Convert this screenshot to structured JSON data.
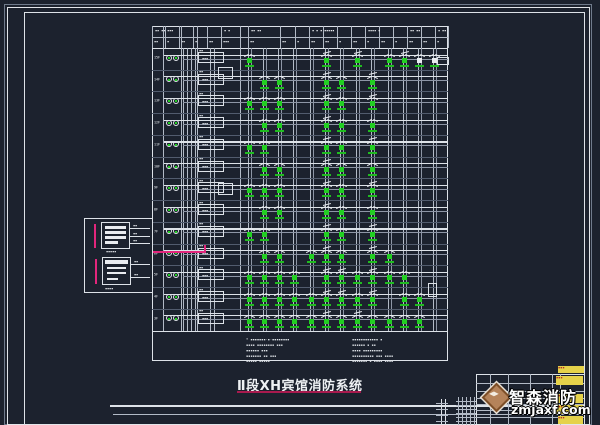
{
  "title": {
    "text": "Ⅱ段XH宾馆消防系统"
  },
  "logo": {
    "name": "智森消防",
    "domain": "zmjaxf.com",
    "diamond_icon": "logo-diamond",
    "accent": "#b5835a"
  },
  "colors": {
    "background": "#1c222e",
    "line": "#b2bac6",
    "bright_line": "#dde2e8",
    "device_green": "#22cf22",
    "magenta": "#e2267c",
    "stamp_yellow": "#e5d24a",
    "title_underline": "#a81a4e"
  },
  "diagram": {
    "box": {
      "left": 152,
      "top": 26,
      "right": 447.5,
      "header_bottom": 48,
      "grid_bottom": 330.5,
      "bottom": 361
    },
    "columns": [
      248,
      263,
      278,
      293,
      310,
      325,
      340,
      356,
      371,
      388,
      403,
      418,
      433
    ],
    "separators": [
      163,
      181,
      197,
      240
    ],
    "risers": [
      183,
      187,
      191,
      195
    ],
    "trunk": [
      209.5,
      213.5
    ],
    "header_cells": [
      0,
      13,
      27,
      41,
      55,
      69,
      96,
      128,
      143,
      157,
      171,
      185,
      199,
      213,
      227,
      241,
      255,
      269,
      283,
      295.5
    ],
    "header_top_tokens": [
      "▪▪ ▪▪ ▪▪▪",
      "▪ ▪",
      "▪▪ ▪▪",
      "▪ ▪ ▪ ▪▪▪▪▪",
      "▪▪▪▪ ▪",
      "▪▪ ▪▪",
      "▪ ▪▪"
    ],
    "header_bot_tokens": [
      "▪▪",
      "▪",
      "▪▪",
      "▪",
      "▪▪",
      "▪▪▪",
      "▪▪",
      "▪▪",
      "▪",
      "▪▪",
      "▪▪",
      "▪",
      "▪▪",
      "▪",
      "▪▪",
      "▪",
      "▪▪",
      "▪▪",
      "▪"
    ],
    "rows": [
      {
        "floor": "15F",
        "devices": [
          [
            1,
            "d"
          ],
          [
            6,
            "w"
          ],
          [
            8,
            "w"
          ],
          [
            10,
            "d"
          ],
          [
            11,
            "w"
          ],
          [
            12,
            "s"
          ],
          [
            13,
            "s"
          ]
        ]
      },
      {
        "floor": "14F",
        "devices": [
          [
            2,
            "d"
          ],
          [
            3,
            "d"
          ],
          [
            6,
            "w"
          ],
          [
            7,
            "d"
          ],
          [
            9,
            "w"
          ]
        ]
      },
      {
        "floor": "13F",
        "devices": [
          [
            1,
            "d"
          ],
          [
            2,
            "d"
          ],
          [
            3,
            "d"
          ],
          [
            6,
            "w"
          ],
          [
            7,
            "d"
          ],
          [
            9,
            "w"
          ]
        ]
      },
      {
        "floor": "12F",
        "devices": [
          [
            2,
            "d"
          ],
          [
            3,
            "d"
          ],
          [
            6,
            "w"
          ],
          [
            7,
            "d"
          ],
          [
            9,
            "d"
          ]
        ]
      },
      {
        "floor": "11F",
        "devices": [
          [
            1,
            "d"
          ],
          [
            2,
            "d"
          ],
          [
            6,
            "w"
          ],
          [
            7,
            "d"
          ],
          [
            9,
            "w"
          ]
        ]
      },
      {
        "floor": "10F",
        "devices": [
          [
            2,
            "d"
          ],
          [
            3,
            "d"
          ],
          [
            6,
            "w"
          ],
          [
            7,
            "d"
          ],
          [
            9,
            "d"
          ]
        ]
      },
      {
        "floor": "9F",
        "devices": [
          [
            1,
            "d"
          ],
          [
            2,
            "d"
          ],
          [
            3,
            "d"
          ],
          [
            6,
            "w"
          ],
          [
            7,
            "d"
          ],
          [
            9,
            "w"
          ]
        ]
      },
      {
        "floor": "8F",
        "devices": [
          [
            2,
            "d"
          ],
          [
            3,
            "d"
          ],
          [
            6,
            "w"
          ],
          [
            7,
            "d"
          ],
          [
            9,
            "d"
          ]
        ]
      },
      {
        "floor": "7F",
        "devices": [
          [
            1,
            "d"
          ],
          [
            2,
            "d"
          ],
          [
            6,
            "w"
          ],
          [
            7,
            "d"
          ],
          [
            9,
            "w"
          ]
        ]
      },
      {
        "floor": "6F",
        "devices": [
          [
            2,
            "d"
          ],
          [
            3,
            "d"
          ],
          [
            5,
            "d"
          ],
          [
            6,
            "w"
          ],
          [
            7,
            "d"
          ],
          [
            9,
            "w"
          ],
          [
            10,
            "d"
          ]
        ]
      },
      {
        "floor": "5F",
        "devices": [
          [
            1,
            "d"
          ],
          [
            2,
            "d"
          ],
          [
            3,
            "d"
          ],
          [
            4,
            "d"
          ],
          [
            6,
            "w"
          ],
          [
            7,
            "w"
          ],
          [
            8,
            "d"
          ],
          [
            9,
            "w"
          ],
          [
            10,
            "d"
          ],
          [
            11,
            "d"
          ]
        ]
      },
      {
        "floor": "4F",
        "devices": [
          [
            1,
            "d"
          ],
          [
            2,
            "d"
          ],
          [
            3,
            "d"
          ],
          [
            4,
            "d"
          ],
          [
            5,
            "d"
          ],
          [
            6,
            "w"
          ],
          [
            7,
            "w"
          ],
          [
            8,
            "d"
          ],
          [
            9,
            "w"
          ],
          [
            11,
            "d"
          ],
          [
            12,
            "d"
          ]
        ]
      },
      {
        "floor": "3F",
        "devices": [
          [
            1,
            "d"
          ],
          [
            2,
            "d"
          ],
          [
            3,
            "d"
          ],
          [
            4,
            "d"
          ],
          [
            5,
            "d"
          ],
          [
            6,
            "w"
          ],
          [
            7,
            "d"
          ],
          [
            8,
            "w"
          ],
          [
            9,
            "d"
          ],
          [
            10,
            "d"
          ],
          [
            11,
            "d"
          ],
          [
            12,
            "d"
          ]
        ]
      }
    ],
    "extra_boxes": [
      [
        218,
        67,
        15,
        12
      ],
      [
        218,
        183,
        15,
        12
      ],
      [
        437,
        57,
        12,
        8
      ],
      [
        428,
        283,
        9,
        14
      ]
    ],
    "dist_box_dash": "▪▪▪"
  },
  "notes": {
    "left_lines": [
      "* ▪▪▪▪▪▪▪-▪-▪▪▪▪▪▪▪▪",
      "▪▪▪▪ ▪▪▪▪▪▪▪▪ ▪▪▪",
      "▪▪▪▪▪▪ ▪▪▪",
      "▪▪▪▪▪▪▪ ▪▪ ▪▪▪",
      "▪▪▪▪▪ ▪▪▪▪▪"
    ],
    "right_lines": [
      "▪▪▪▪▪▪▪▪▪▪▪▪ ▪",
      "▪▪▪▪▪▪ ▪ ▪▪",
      "▪▪▪▪ ▪▪▪▪▪▪▪▪▪",
      "▪▪▪▪▪▪▪▪▪▪ ▪▪▪ ▪▪▪▪",
      "▪▪▪▪▪▪▪ ▪ ▪▪▪▪ ▪▪▪▪"
    ]
  },
  "panel": {
    "box1_label": "▪▪▪▪▪",
    "box2_label": "▪▪▪▪",
    "wire_labels": [
      "▪▪",
      "▪▪",
      "▪▪",
      "▪▪",
      "▪▪"
    ]
  },
  "title_block": {
    "hlines": [
      383,
      390.5,
      398,
      403.5,
      410,
      417
    ],
    "vlines": [
      490,
      508,
      530,
      552,
      560
    ],
    "chips": [
      [
        556,
        376,
        27,
        9
      ],
      [
        556,
        394,
        27,
        9
      ],
      [
        556,
        405,
        27,
        9
      ],
      [
        558,
        416,
        25,
        8
      ],
      [
        558,
        366,
        26,
        7
      ]
    ],
    "chip_token": "▪▪▪"
  }
}
